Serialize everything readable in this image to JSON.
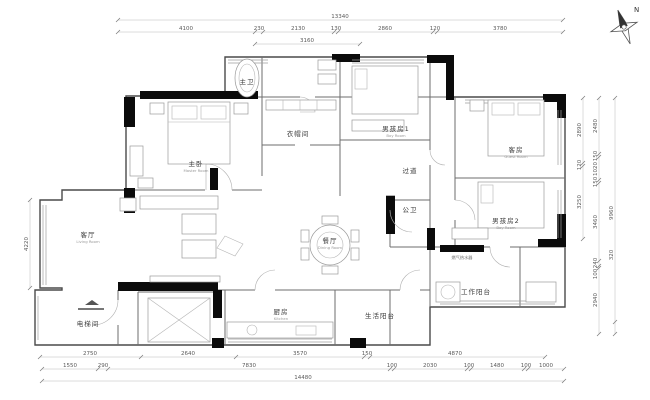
{
  "compass": {
    "north_label": "N"
  },
  "dims": {
    "top_total": "13340",
    "top_row": [
      "4100",
      "230",
      "2130",
      "130",
      "2860",
      "120",
      "3780"
    ],
    "top_sub": "3160",
    "bottom_row1": [
      "2750",
      "2640",
      "3570",
      "150",
      "4870"
    ],
    "bottom_row2": [
      "1550",
      "290",
      "7830",
      "100",
      "2030",
      "100",
      "1480",
      "100",
      "1000"
    ],
    "bottom_total": "14480",
    "left": [
      "4220"
    ],
    "right_inner": [
      "2890",
      "120",
      "3250"
    ],
    "right_mid": [
      "2480",
      "150",
      "1020",
      "150",
      "3460",
      "240",
      "100",
      "2940"
    ],
    "right_outer": [
      "9960",
      "320"
    ]
  },
  "rooms": [
    {
      "label": "主卧",
      "sub": "Master Room"
    },
    {
      "label": "主卫",
      "sub": ""
    },
    {
      "label": "衣帽间",
      "sub": ""
    },
    {
      "label": "男孩房1",
      "sub": "Boy Room"
    },
    {
      "label": "客房",
      "sub": "Guest Room"
    },
    {
      "label": "男孩房2",
      "sub": "Boy Room"
    },
    {
      "label": "过道",
      "sub": ""
    },
    {
      "label": "公卫",
      "sub": ""
    },
    {
      "label": "餐厅",
      "sub": "Dining Room"
    },
    {
      "label": "客厅",
      "sub": "Living Room"
    },
    {
      "label": "厨房",
      "sub": "Kitchen"
    },
    {
      "label": "电梯间",
      "sub": ""
    },
    {
      "label": "工作阳台",
      "sub": ""
    },
    {
      "label": "生活阳台",
      "sub": ""
    },
    {
      "label": "燃气热水器",
      "sub": ""
    }
  ]
}
